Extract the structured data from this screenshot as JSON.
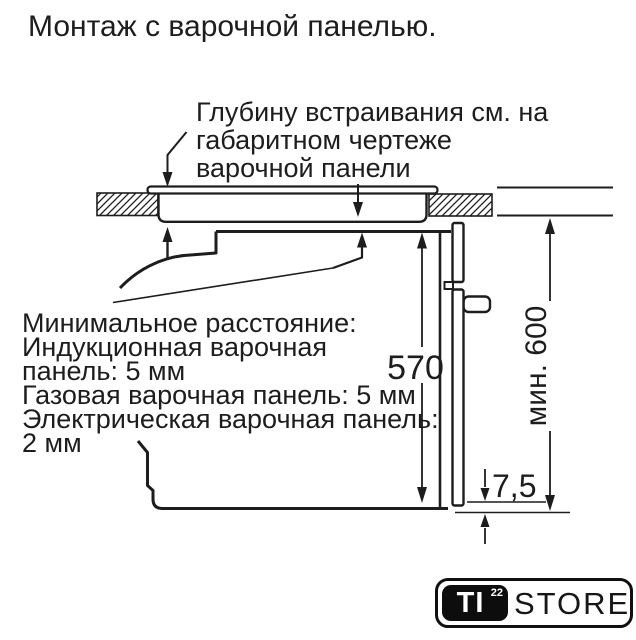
{
  "page": {
    "title": "Монтаж с варочной панелью."
  },
  "diagram": {
    "callout": {
      "lines": [
        "Глубину встраивания см. на",
        "габаритном чертеже",
        "варочной панели"
      ]
    },
    "note": {
      "lines": [
        "Минимальное расстояние:",
        "Индукционная варочная",
        "панель: 5 мм",
        "Газовая варочная панель: 5 мм",
        "Электрическая варочная панель:",
        "2 мм"
      ]
    },
    "dimensions": {
      "niche_height": "570",
      "min_worktop_height": "мин. 600",
      "bottom_gap": "7,5"
    }
  },
  "logo": {
    "brand": "TI",
    "superscript": "22",
    "suffix": "STORE"
  },
  "colors": {
    "ink": "#1d1d1d",
    "background": "#ffffff"
  }
}
